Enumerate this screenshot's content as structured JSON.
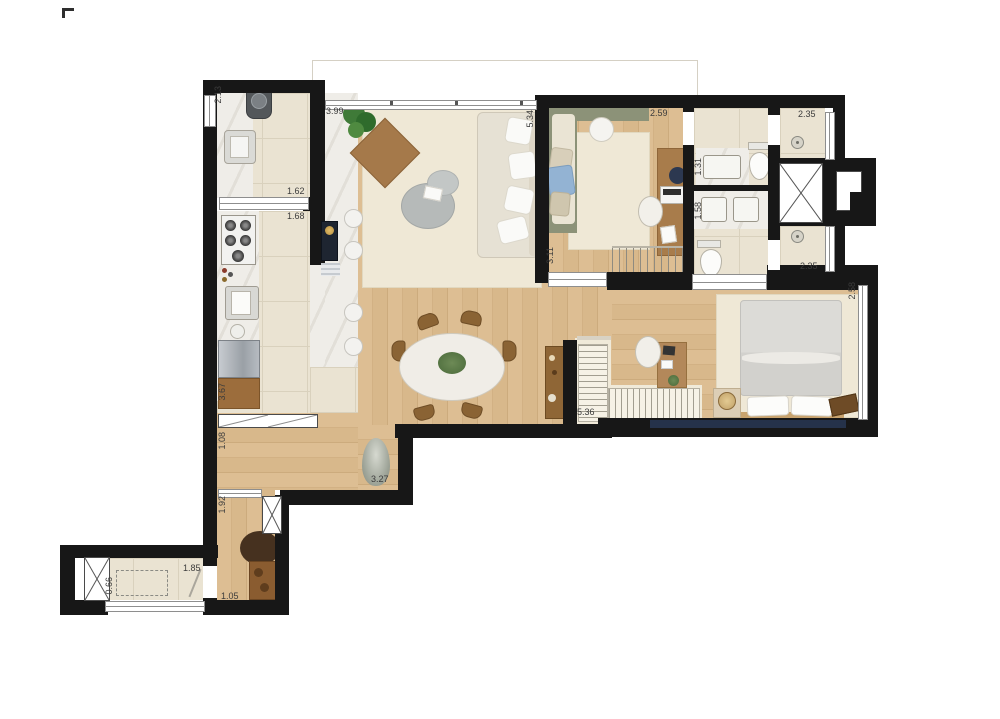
{
  "type": "apartment-floor-plan",
  "palette": {
    "wall": "#171717",
    "wood_floor": "#d8b88b",
    "tile_floor": "#eae3d2",
    "marble": "#efede8",
    "rug_cream": "#efe8d6",
    "daybed_green": "#8c9278",
    "window_navy": "#25324a",
    "wood_furniture": "#9b6c3b"
  },
  "dimensions": [
    {
      "id": "service-width",
      "text": "2.13"
    },
    {
      "id": "kitchen-passage",
      "text": "3.99"
    },
    {
      "id": "service-length",
      "text": "1.62"
    },
    {
      "id": "kitchen-width",
      "text": "1.68"
    },
    {
      "id": "living-depth",
      "text": "5.34"
    },
    {
      "id": "office-width",
      "text": "2.59"
    },
    {
      "id": "shower1-width",
      "text": "2.35"
    },
    {
      "id": "bath1-width",
      "text": "1.31"
    },
    {
      "id": "bath2-width",
      "text": "1.58"
    },
    {
      "id": "office-depth",
      "text": "3.11"
    },
    {
      "id": "shower2-width",
      "text": "2.35"
    },
    {
      "id": "bedroom-depth",
      "text": "2.58"
    },
    {
      "id": "kitchen-length",
      "text": "3.67"
    },
    {
      "id": "closet-length",
      "text": "5.36"
    },
    {
      "id": "hall-width",
      "text": "1.08"
    },
    {
      "id": "living-width",
      "text": "3.27"
    },
    {
      "id": "corridor-length",
      "text": "1.92"
    },
    {
      "id": "laundry-length",
      "text": "1.85"
    },
    {
      "id": "laundry-width",
      "text": "0.66"
    },
    {
      "id": "entry-width",
      "text": "1.05"
    }
  ]
}
